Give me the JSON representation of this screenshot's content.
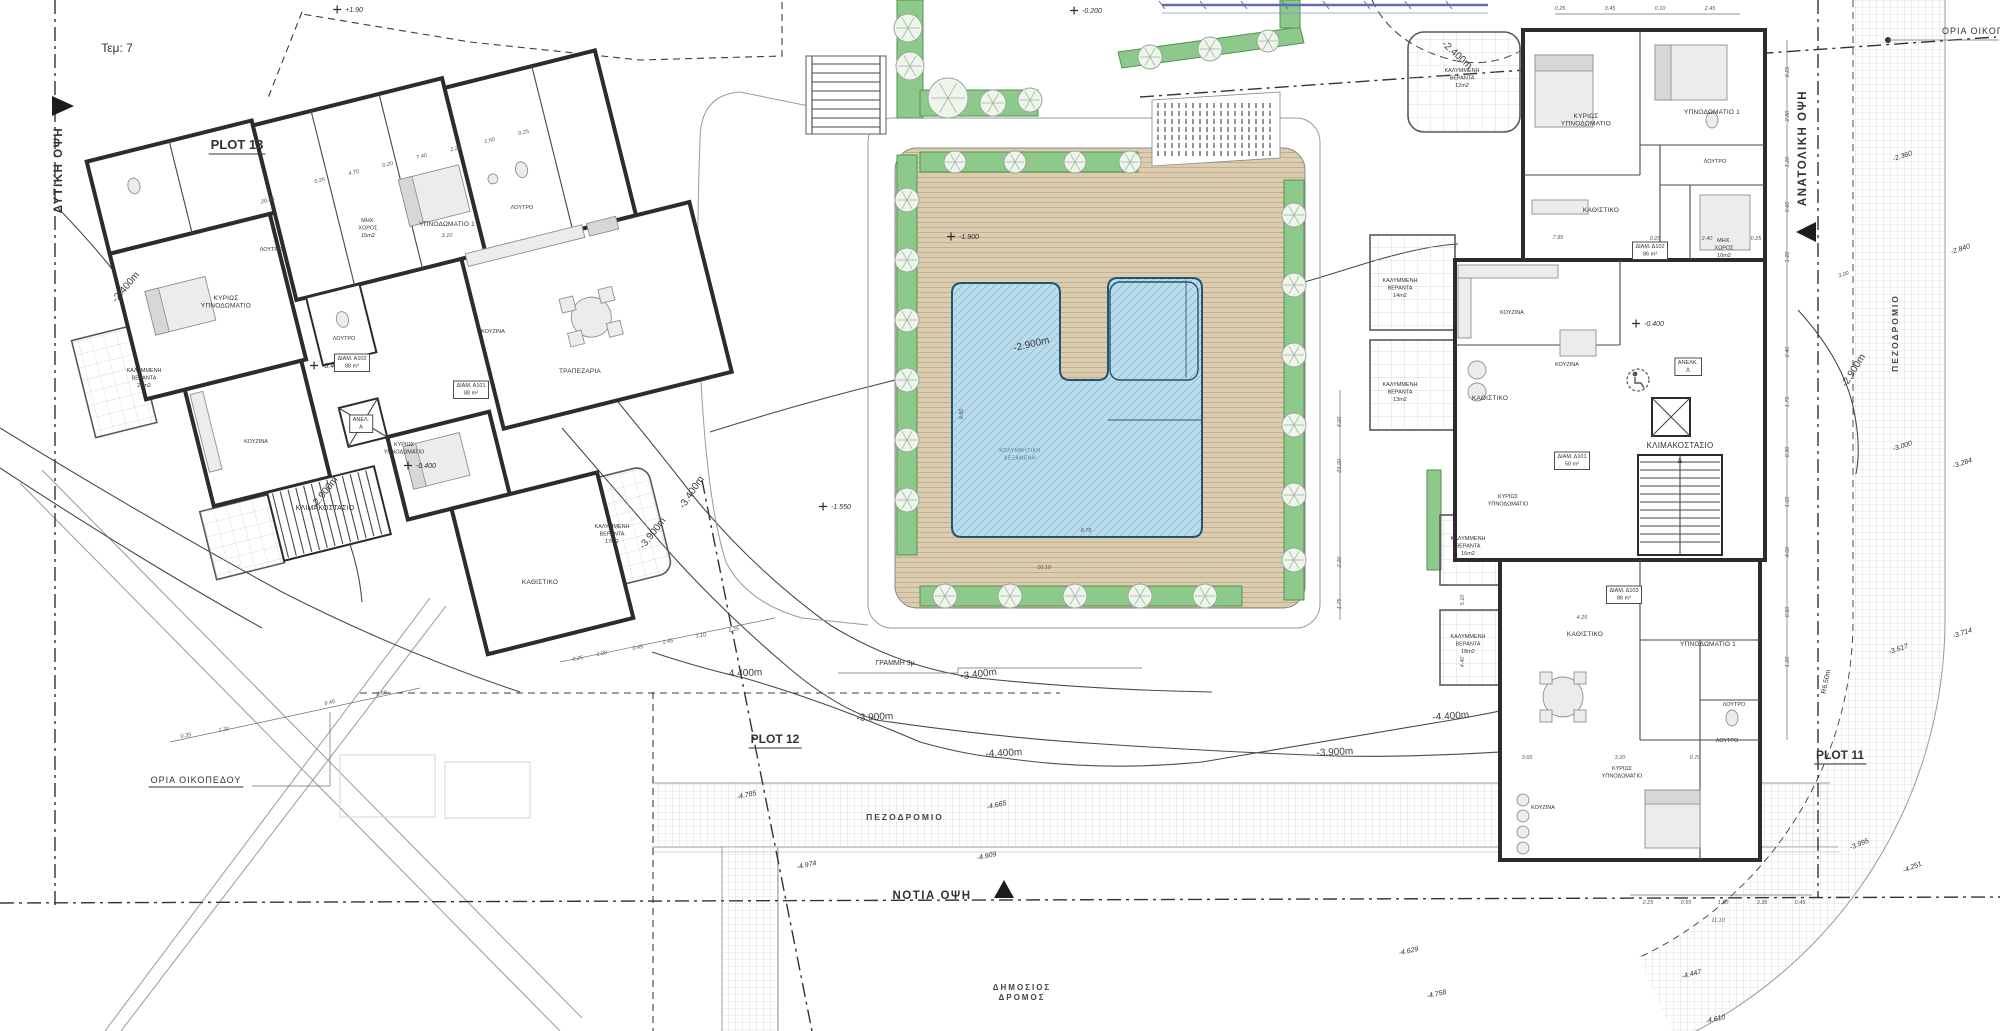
{
  "colors": {
    "wall_dark": "#2c2c2c",
    "deck_tan": "#dccdb0",
    "planting_green": "#8cc98b",
    "pool_blue": "#bcdcec",
    "pool_line": "#23556e",
    "accent_blue": "#646ab4",
    "hatch_gray": "#c8c8c8"
  },
  "labels": {
    "titles": [
      {
        "t": "Τεμ: 7",
        "x": 117,
        "y": 52,
        "n": "parcel-label"
      }
    ],
    "plots": [
      {
        "t": "PLOT 13",
        "x": 237,
        "y": 149,
        "u": 1,
        "n": "plot-13-label"
      },
      {
        "t": "PLOT 12",
        "x": 775,
        "y": 743,
        "s": 12,
        "u": 1,
        "n": "plot-12-label"
      },
      {
        "t": "PLOT 11",
        "x": 1840,
        "y": 759,
        "s": 12,
        "u": 1,
        "n": "plot-11-label"
      }
    ],
    "views": [
      {
        "t": "ΔΥΤΙΚΗ ΟΨΗ",
        "x": 62,
        "y": 170,
        "r": -90,
        "n": "west-elevation-label"
      },
      {
        "t": "ΑΝΑΤΟΛΙΚΗ ΟΨΗ",
        "x": 1806,
        "y": 148,
        "r": -90,
        "n": "east-elevation-label"
      },
      {
        "t": "ΝΟΤΙΑ ΟΨΗ",
        "x": 932,
        "y": 899,
        "n": "south-elevation-label"
      }
    ],
    "boundaries": [
      {
        "t": "ΟΡΙΑ ΟΙΚΟΠΕΔΟΥ",
        "x": 196,
        "y": 783,
        "u": 1,
        "n": "plot-boundary-label-sw"
      },
      {
        "t": "ΟΡΙΑ ΟΙΚΟΠΕΔΟΥ",
        "x": 1942,
        "y": 34,
        "a": "start",
        "n": "plot-boundary-label-ne"
      }
    ],
    "roads": [
      {
        "t": "ΠΕΖΟΔΡΟΜΙΟ",
        "x": 905,
        "y": 820,
        "n": "sidewalk-label-south"
      },
      {
        "t": "ΠΕΖΟΔΡΟΜΙΟ",
        "x": 1898,
        "y": 333,
        "r": -90,
        "n": "sidewalk-label-east"
      },
      {
        "lines": [
          "ΔΗΜΟΣΙΟΣ",
          "ΔΡΟΜΟΣ"
        ],
        "x": 1022,
        "y": 990,
        "s": 8,
        "n": "public-road-label"
      },
      {
        "t": "ΓΡΑΜΜΗ 3μ.",
        "x": 896,
        "y": 665,
        "c": "gram",
        "n": "setback-line-label"
      },
      {
        "t": "R6.50m",
        "x": 1828,
        "y": 682,
        "r": -78,
        "c": "gram",
        "n": "radius-label"
      }
    ],
    "contours": [
      {
        "t": "-2.400m",
        "x": 1455,
        "y": 57,
        "r": 42
      },
      {
        "t": "-2.400m",
        "x": 128,
        "y": 289,
        "r": -50
      },
      {
        "t": "-2.900m",
        "x": 327,
        "y": 494,
        "r": -52
      },
      {
        "t": "-2.900m",
        "x": 1032,
        "y": 347,
        "r": -13
      },
      {
        "t": "-2.900m",
        "x": 1856,
        "y": 372,
        "r": -58
      },
      {
        "t": "-3.400m",
        "x": 694,
        "y": 494,
        "r": -56
      },
      {
        "t": "-3.400m",
        "x": 979,
        "y": 677,
        "r": -7
      },
      {
        "t": "-3.900m",
        "x": 655,
        "y": 535,
        "r": -52
      },
      {
        "t": "-3.900m",
        "x": 875,
        "y": 720,
        "r": -3
      },
      {
        "t": "-3.900m",
        "x": 1335,
        "y": 755,
        "r": -3
      },
      {
        "t": "-4.400m",
        "x": 744,
        "y": 676,
        "r": -2
      },
      {
        "t": "-4.400m",
        "x": 1004,
        "y": 756,
        "r": -3
      },
      {
        "t": "-4.400m",
        "x": 1451,
        "y": 719,
        "r": -4
      }
    ],
    "spots": [
      {
        "t": "+1.90",
        "x": 354,
        "y": 12,
        "m": 1
      },
      {
        "t": "-0.200",
        "x": 1092,
        "y": 13,
        "m": 1
      },
      {
        "t": "-1.900",
        "x": 969,
        "y": 239,
        "m": 1
      },
      {
        "t": "-1.550",
        "x": 841,
        "y": 509,
        "m": 1
      },
      {
        "t": "-0.400",
        "x": 332,
        "y": 368,
        "m": 1
      },
      {
        "t": "-0.400",
        "x": 426,
        "y": 468,
        "m": 1
      },
      {
        "t": "-0.400",
        "x": 1654,
        "y": 326,
        "m": 1
      },
      {
        "t": "-2.360",
        "x": 1903,
        "y": 158,
        "r": -18
      },
      {
        "t": "-2.840",
        "x": 1961,
        "y": 251,
        "r": -18
      },
      {
        "t": "-3.000",
        "x": 1903,
        "y": 448,
        "r": -18
      },
      {
        "t": "-3.284",
        "x": 1963,
        "y": 465,
        "r": -18
      },
      {
        "t": "-3.517",
        "x": 1899,
        "y": 651,
        "r": -18
      },
      {
        "t": "-3.714",
        "x": 1963,
        "y": 635,
        "r": -18
      },
      {
        "t": "-3.995",
        "x": 1860,
        "y": 846,
        "r": -22
      },
      {
        "t": "-4.251",
        "x": 1913,
        "y": 869,
        "r": -22
      },
      {
        "t": "-4.447",
        "x": 1692,
        "y": 976,
        "r": -14
      },
      {
        "t": "-4.610",
        "x": 1716,
        "y": 1021,
        "r": -12
      },
      {
        "t": "-4.629",
        "x": 1409,
        "y": 953,
        "r": -12
      },
      {
        "t": "-4.758",
        "x": 1437,
        "y": 996,
        "r": -12
      },
      {
        "t": "-4.785",
        "x": 747,
        "y": 797,
        "r": -12
      },
      {
        "t": "-4.665",
        "x": 997,
        "y": 807,
        "r": -12
      },
      {
        "t": "-4.974",
        "x": 807,
        "y": 867,
        "r": -12
      },
      {
        "t": "-4.909",
        "x": 987,
        "y": 858,
        "r": -12
      }
    ],
    "rooms_left": [
      {
        "lines": [
          "ΚΥΡΙΩΣ",
          "ΥΠΝΟΔΩΜΑΤΙΟ"
        ],
        "x": 226,
        "y": 300
      },
      {
        "t": "ΛΟΥΤΡΟ",
        "x": 271,
        "y": 251,
        "c": "rs"
      },
      {
        "lines": [
          "ΚΑΛΥΜΜΕΝΗ",
          "ΒΕΡΑΝΤΑ",
          "21m2"
        ],
        "x": 144,
        "y": 372,
        "c": "rs"
      },
      {
        "t": "ΚΟΥΖΙΝΑ",
        "x": 256,
        "y": 443,
        "c": "rs"
      },
      {
        "t": "ΥΠΝΟΔΩΜΑΤΙΟ 1",
        "x": 447,
        "y": 226
      },
      {
        "t": "ΛΟΥΤΡΟ",
        "x": 522,
        "y": 209,
        "c": "rs"
      },
      {
        "t": "ΚΟΥΖΙΝΑ",
        "x": 493,
        "y": 333,
        "c": "rs"
      },
      {
        "t": "ΤΡΑΠΕΖΑΡΙΑ",
        "x": 580,
        "y": 373
      },
      {
        "lines": [
          "ΜΗΧ.",
          "ΧΩΡΟΣ",
          "15m2"
        ],
        "x": 368,
        "y": 222,
        "c": "rs"
      },
      {
        "t": "ΛΟΥΤΡΟ",
        "x": 344,
        "y": 340,
        "c": "rs"
      },
      {
        "lines": [
          "ΔΙΑΜ. Α102",
          "88 m²"
        ],
        "x": 352,
        "y": 360,
        "b": 1,
        "c": "rs"
      },
      {
        "lines": [
          "ΔΙΑΜ. Α101",
          "88 m²"
        ],
        "x": 471,
        "y": 387,
        "b": 1,
        "c": "rs"
      },
      {
        "lines": [
          "ΑΝΕΛ.",
          "Α"
        ],
        "x": 361,
        "y": 421,
        "b": 1,
        "c": "rs"
      },
      {
        "t": "ΚΛΙΜΑΚΟΣΤΑΣΙΟ",
        "x": 325,
        "y": 510,
        "s": 7
      },
      {
        "lines": [
          "ΚΥΡΙΩΣ",
          "ΥΠΝΟΔΩΜΑΤΙΟ"
        ],
        "x": 404,
        "y": 446,
        "c": "rs"
      },
      {
        "t": "ΚΑΘΙΣΤΙΚΟ",
        "x": 540,
        "y": 584
      },
      {
        "lines": [
          "ΚΑΛΥΜΜΕΝΗ",
          "ΒΕΡΑΝΤΑ",
          "17m2"
        ],
        "x": 612,
        "y": 528,
        "c": "rs"
      }
    ],
    "rooms_right": [
      {
        "lines": [
          "ΚΥΡΙΩΣ",
          "ΥΠΝΟΔΩΜΑΤΙΟ"
        ],
        "x": 1586,
        "y": 118
      },
      {
        "t": "ΥΠΝΟΔΩΜΑΤΙΟ 1",
        "x": 1712,
        "y": 114
      },
      {
        "t": "ΛΟΥΤΡΟ",
        "x": 1715,
        "y": 163,
        "c": "rs"
      },
      {
        "t": "ΚΑΘΙΣΤΙΚΟ",
        "x": 1601,
        "y": 212
      },
      {
        "lines": [
          "ΜΗΧ.",
          "ΧΩΡΟΣ",
          "10m2"
        ],
        "x": 1724,
        "y": 242,
        "c": "rs"
      },
      {
        "lines": [
          "ΔΙΑΜ. Δ102",
          "86 m²"
        ],
        "x": 1650,
        "y": 248,
        "b": 1,
        "c": "rs"
      },
      {
        "t": "ΚΟΥΖΙΝΑ",
        "x": 1512,
        "y": 314,
        "c": "rs"
      },
      {
        "t": "ΚΟΥΖΙΝΑ",
        "x": 1567,
        "y": 366,
        "c": "rs"
      },
      {
        "t": "ΚΑΘΙΣΤΙΚΟ",
        "x": 1490,
        "y": 400
      },
      {
        "lines": [
          "ΑΝΕΛΚ.",
          "Δ"
        ],
        "x": 1688,
        "y": 364,
        "b": 1,
        "c": "rs"
      },
      {
        "t": "ΚΛΙΜΑΚΟΣΤΑΣΙΟ",
        "x": 1680,
        "y": 448,
        "s": 8
      },
      {
        "t": "Δ",
        "x": 1680,
        "y": 463,
        "s": 7
      },
      {
        "lines": [
          "ΚΥΡΙΩΣ",
          "ΥΠΝΟΔΩΜΑΤΙΟ"
        ],
        "x": 1508,
        "y": 498,
        "c": "rs"
      },
      {
        "lines": [
          "ΔΙΑΜ. Δ101",
          "50 m²"
        ],
        "x": 1572,
        "y": 458,
        "b": 1,
        "c": "rs"
      },
      {
        "lines": [
          "ΚΑΛΥΜΜΕΝΗ",
          "ΒΕΡΑΝΤΑ",
          "12m2"
        ],
        "x": 1462,
        "y": 72,
        "c": "rs"
      },
      {
        "lines": [
          "ΚΑΛΥΜΜΕΝΗ",
          "ΒΕΡΑΝΤΑ",
          "14m2"
        ],
        "x": 1400,
        "y": 282,
        "c": "rs"
      },
      {
        "lines": [
          "ΚΑΛΥΜΜΕΝΗ",
          "ΒΕΡΑΝΤΑ",
          "13m2"
        ],
        "x": 1400,
        "y": 386,
        "c": "rs"
      },
      {
        "lines": [
          "ΚΑΛΥΜΜΕΝΗ",
          "ΒΕΡΑΝΤΑ",
          "16m2"
        ],
        "x": 1468,
        "y": 540,
        "c": "rs"
      },
      {
        "lines": [
          "ΚΑΛΥΜΜΕΝΗ",
          "ΒΕΡΑΝΤΑ",
          "18m2"
        ],
        "x": 1468,
        "y": 638,
        "c": "rs"
      },
      {
        "t": "ΚΑΘΙΣΤΙΚΟ",
        "x": 1585,
        "y": 636
      },
      {
        "t": "ΥΠΝΟΔΩΜΑΤΙΟ 1",
        "x": 1708,
        "y": 646
      },
      {
        "t": "ΛΟΥΤΡΟ",
        "x": 1734,
        "y": 706,
        "c": "rs"
      },
      {
        "t": "ΛΟΥΤΡΟ",
        "x": 1727,
        "y": 742,
        "c": "rs"
      },
      {
        "lines": [
          "ΚΥΡΙΩΣ",
          "ΥΠΝΟΔΩΜΑΤΙΟ"
        ],
        "x": 1622,
        "y": 770,
        "c": "rs"
      },
      {
        "t": "ΚΟΥΖΙΝΑ",
        "x": 1543,
        "y": 809,
        "c": "rs"
      },
      {
        "lines": [
          "ΔΙΑΜ. Δ103",
          "86 m²"
        ],
        "x": 1624,
        "y": 592,
        "b": 1,
        "c": "rs"
      }
    ],
    "pool": [
      {
        "lines": [
          "ΚΟΛΥΜΒΗΤΙΚΗ",
          "ΔΕΞΑΜΕΝΗ"
        ],
        "x": 1020,
        "y": 452,
        "n": "pool-label"
      }
    ],
    "dims": [
      {
        "t": "20.85",
        "x": 268,
        "y": 202,
        "r": -13
      },
      {
        "t": "0.25",
        "x": 320,
        "y": 182,
        "r": -13
      },
      {
        "t": "4.70",
        "x": 354,
        "y": 174,
        "r": -13
      },
      {
        "t": "0.20",
        "x": 388,
        "y": 166,
        "r": -13
      },
      {
        "t": "7.40",
        "x": 422,
        "y": 158,
        "r": -13
      },
      {
        "t": "2.20",
        "x": 456,
        "y": 150,
        "r": -13
      },
      {
        "t": "1.50",
        "x": 490,
        "y": 142,
        "r": -13
      },
      {
        "t": "0.25",
        "x": 524,
        "y": 134,
        "r": -13
      },
      {
        "t": "3.10",
        "x": 447,
        "y": 237
      },
      {
        "t": "0.25",
        "x": 578,
        "y": 660,
        "r": -10
      },
      {
        "t": "1.20",
        "x": 602,
        "y": 655,
        "r": -10
      },
      {
        "t": "0.45",
        "x": 638,
        "y": 649,
        "r": -10
      },
      {
        "t": "1.45",
        "x": 668,
        "y": 643,
        "r": -10
      },
      {
        "t": "3.10",
        "x": 701,
        "y": 637,
        "r": -10
      },
      {
        "t": "1.25",
        "x": 734,
        "y": 631,
        "r": -10
      },
      {
        "t": "0.35",
        "x": 186,
        "y": 737,
        "r": -10
      },
      {
        "t": "1.30",
        "x": 224,
        "y": 731,
        "r": -10
      },
      {
        "t": "9.45",
        "x": 330,
        "y": 704,
        "r": -12
      },
      {
        "t": "0.60",
        "x": 382,
        "y": 695,
        "r": -12
      },
      {
        "t": "9.80",
        "x": 963,
        "y": 414,
        "r": -90
      },
      {
        "t": "8.75",
        "x": 1086,
        "y": 532
      },
      {
        "t": "10.10",
        "x": 1044,
        "y": 569
      },
      {
        "t": "4.00",
        "x": 1341,
        "y": 422,
        "r": -90
      },
      {
        "t": "23.20",
        "x": 1341,
        "y": 466,
        "r": -90
      },
      {
        "t": "2.20",
        "x": 1341,
        "y": 562,
        "r": -90
      },
      {
        "t": "1.75",
        "x": 1341,
        "y": 604,
        "r": -90
      },
      {
        "t": "0.25",
        "x": 1789,
        "y": 72,
        "r": -90
      },
      {
        "t": "2.80",
        "x": 1789,
        "y": 116,
        "r": -90
      },
      {
        "t": "1.20",
        "x": 1789,
        "y": 162,
        "r": -90
      },
      {
        "t": "0.60",
        "x": 1789,
        "y": 207,
        "r": -90
      },
      {
        "t": "1.20",
        "x": 1789,
        "y": 257,
        "r": -90
      },
      {
        "t": "0.40",
        "x": 1789,
        "y": 352,
        "r": -90
      },
      {
        "t": "1.75",
        "x": 1789,
        "y": 402,
        "r": -90
      },
      {
        "t": "0.90",
        "x": 1789,
        "y": 452,
        "r": -90
      },
      {
        "t": "1.65",
        "x": 1789,
        "y": 502,
        "r": -90
      },
      {
        "t": "4.00",
        "x": 1789,
        "y": 552,
        "r": -90
      },
      {
        "t": "0.60",
        "x": 1789,
        "y": 612,
        "r": -90
      },
      {
        "t": "1.20",
        "x": 1789,
        "y": 662,
        "r": -90
      },
      {
        "t": "3.00",
        "x": 1844,
        "y": 276,
        "r": -18
      },
      {
        "t": "7.95",
        "x": 1558,
        "y": 239
      },
      {
        "t": "0.25",
        "x": 1655,
        "y": 240
      },
      {
        "t": "2.40",
        "x": 1707,
        "y": 240
      },
      {
        "t": "0.25",
        "x": 1756,
        "y": 240
      },
      {
        "t": "4.25",
        "x": 1582,
        "y": 619
      },
      {
        "t": "3.65",
        "x": 1527,
        "y": 759
      },
      {
        "t": "3.20",
        "x": 1620,
        "y": 759
      },
      {
        "t": "0.70",
        "x": 1695,
        "y": 759
      },
      {
        "t": "4.40",
        "x": 1464,
        "y": 662,
        "r": -90
      },
      {
        "t": "5.10",
        "x": 1464,
        "y": 600,
        "r": -90
      },
      {
        "t": "2.25",
        "x": 1648,
        "y": 904
      },
      {
        "t": "0.55",
        "x": 1686,
        "y": 904
      },
      {
        "t": "1.50",
        "x": 1723,
        "y": 904
      },
      {
        "t": "3.35",
        "x": 1762,
        "y": 904
      },
      {
        "t": "0.45",
        "x": 1800,
        "y": 904
      },
      {
        "t": "11.10",
        "x": 1718,
        "y": 922
      },
      {
        "t": "0.25",
        "x": 1560,
        "y": 10
      },
      {
        "t": "3.45",
        "x": 1610,
        "y": 10
      },
      {
        "t": "0.10",
        "x": 1660,
        "y": 10
      },
      {
        "t": "2.45",
        "x": 1710,
        "y": 10
      }
    ]
  }
}
